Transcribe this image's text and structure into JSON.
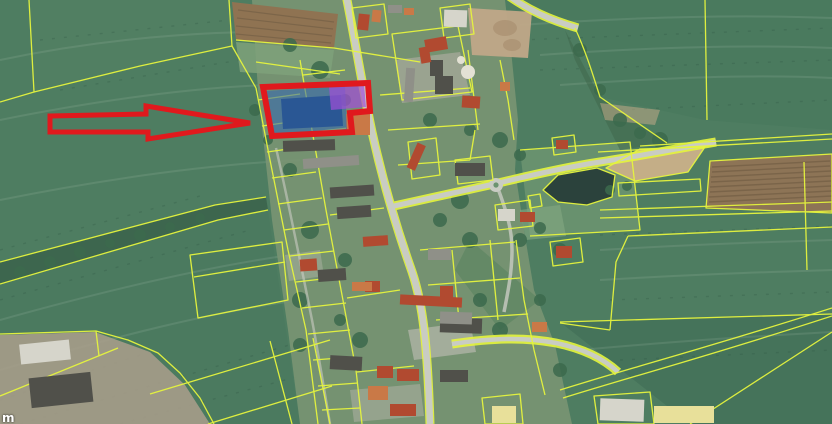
{
  "map": {
    "description": "Aerial cadastral map of a village, parcel boundaries overlaid, red arrow pointing to a highlighted parcel",
    "scale_label": "m",
    "colors": {
      "field_green": "#4e7d61",
      "parcel_line": "#e6f53e",
      "highlight_outline": "#e0191d",
      "highlight_fill_blue": "#2f64b4",
      "highlight_fill_purple": "#a24fd8",
      "arrow": "#e0191d",
      "pond": "#2b423c",
      "road": "#c9ccc3",
      "tree": "#3c6a4d",
      "plowed_field": "#8d7456",
      "dirt": "#c4ae87",
      "village_ground": "#7a9573",
      "roof_red": "#b14a30",
      "roof_orange": "#c97947",
      "roof_gray": "#8f9088",
      "roof_dark": "#50504a",
      "roof_white": "#d6d5cb",
      "roof_bright": "#e8e09a"
    },
    "annotations": {
      "arrow": {
        "name": "pointer-arrow",
        "direction": "right"
      },
      "highlighted_parcel": {
        "name": "selected-parcel",
        "outline": "red",
        "fill": "blue-purple"
      }
    }
  }
}
